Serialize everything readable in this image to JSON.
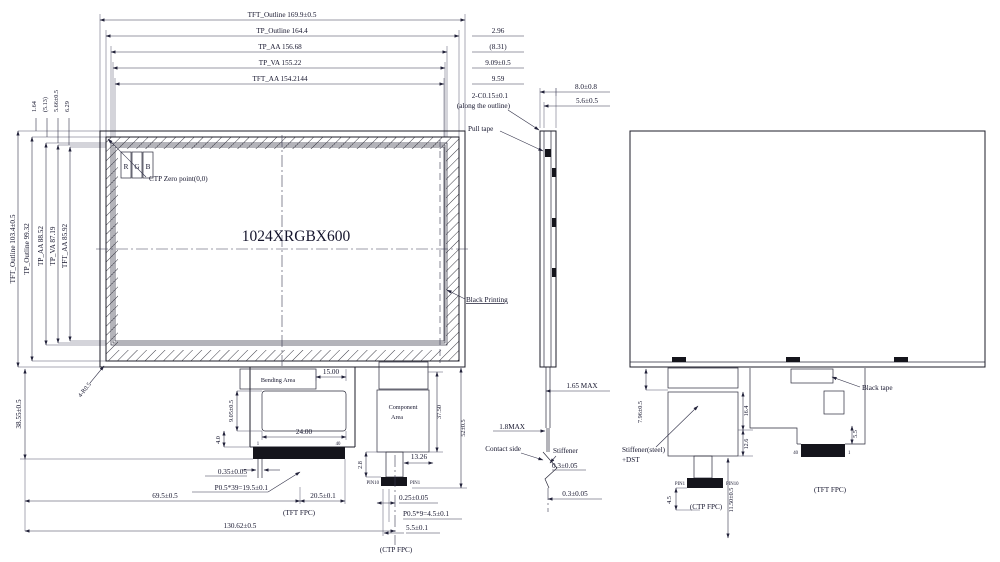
{
  "front_view": {
    "horizontal_dims": [
      {
        "label": "TFT_Outline 169.9±0.5"
      },
      {
        "label": "TP_Outline 164.4"
      },
      {
        "label": "TP_AA 156.68"
      },
      {
        "label": "TP_VA 155.22"
      },
      {
        "label": "TFT_AA 154.2144"
      }
    ],
    "right_offset_dims": [
      {
        "label": "2.96"
      },
      {
        "label": "(8.31)"
      },
      {
        "label": "9.09±0.5"
      },
      {
        "label": "9.59"
      }
    ],
    "vertical_dims": [
      {
        "label": "TFT_Outline 103.4±0.5"
      },
      {
        "label": "TP_Outline 99.32"
      },
      {
        "label": "TP_AA 88.52"
      },
      {
        "label": "TP_VA 87.19"
      },
      {
        "label": "TFT_AA 85.92"
      }
    ],
    "top_offset_dims": [
      {
        "label": "1.64"
      },
      {
        "label": "(5.13)"
      },
      {
        "label": "5.66±0.5"
      },
      {
        "label": "6.29"
      }
    ],
    "resolution_label": "1024XRGBX600",
    "subpixels": [
      "R",
      "G",
      "B"
    ],
    "ctp_zero_label": "CTP Zero point(0,0)",
    "black_printing_label": "Black Printing",
    "corner_radius_label": "4-R0.5",
    "bottom_height_dim": "38.55±0.5",
    "tft_fpc": {
      "bending_area_label": "Bending Area",
      "dim_15": "15.00",
      "dim_24": "24.00",
      "dim_905": "9.05±0.5",
      "dim_40": "4.0",
      "pin_first": "1",
      "pin_last": "40",
      "dim_035": "0.35±0.05",
      "pitch": "P0.5*39=19.5±0.1",
      "dim_695": "69.5±0.5",
      "dim_205": "20.5±0.1",
      "label": "(TFT FPC)",
      "dim_13062": "130.62±0.5"
    },
    "ctp_fpc": {
      "component_area_line1": "Component",
      "component_area_line2": "Area",
      "dim_375": "37.50",
      "dim_52": "52±0.5",
      "dim_1326": "13.26",
      "dim_28": "2.8",
      "pin_left": "PIN10",
      "pin_right": "PIN1",
      "dim_025": "0.25±0.05",
      "pitch": "P0.5*9=4.5±0.1",
      "dim_55": "5.5±0.1",
      "label": "(CTP FPC)"
    }
  },
  "side_view": {
    "dim_80": "8.0±0.8",
    "dim_56": "5.6±0.5",
    "chamfer_line1": "2-C0.15±0.1",
    "chamfer_line2": "(along the outline)",
    "pull_tape_label": "Pull tape",
    "dim_165": "1.65 MAX",
    "dim_18": "1.8MAX",
    "contact_side_label": "Contact side",
    "stiffener_label": "Stiffener",
    "dim_03_upper": "0.3±0.05",
    "dim_03_lower": "0.3±0.05"
  },
  "rear_view": {
    "black_tape_label": "Black tape",
    "stiffener_line1": "Stiffener(steel)",
    "stiffener_line2": "+DST",
    "dim_796": "7.96±0.5",
    "dim_164": "16.4",
    "dim_126": "12.6",
    "dim_55": "5.5",
    "pin_40": "40",
    "pin_1": "1",
    "pin_left": "PIN1",
    "pin_right": "PIN10",
    "dim_45": "4.5",
    "ctp_fpc_label": "(CTP FPC)",
    "dim_1150": "11.50±0.5",
    "tft_fpc_label": "(TFT FPC)"
  }
}
